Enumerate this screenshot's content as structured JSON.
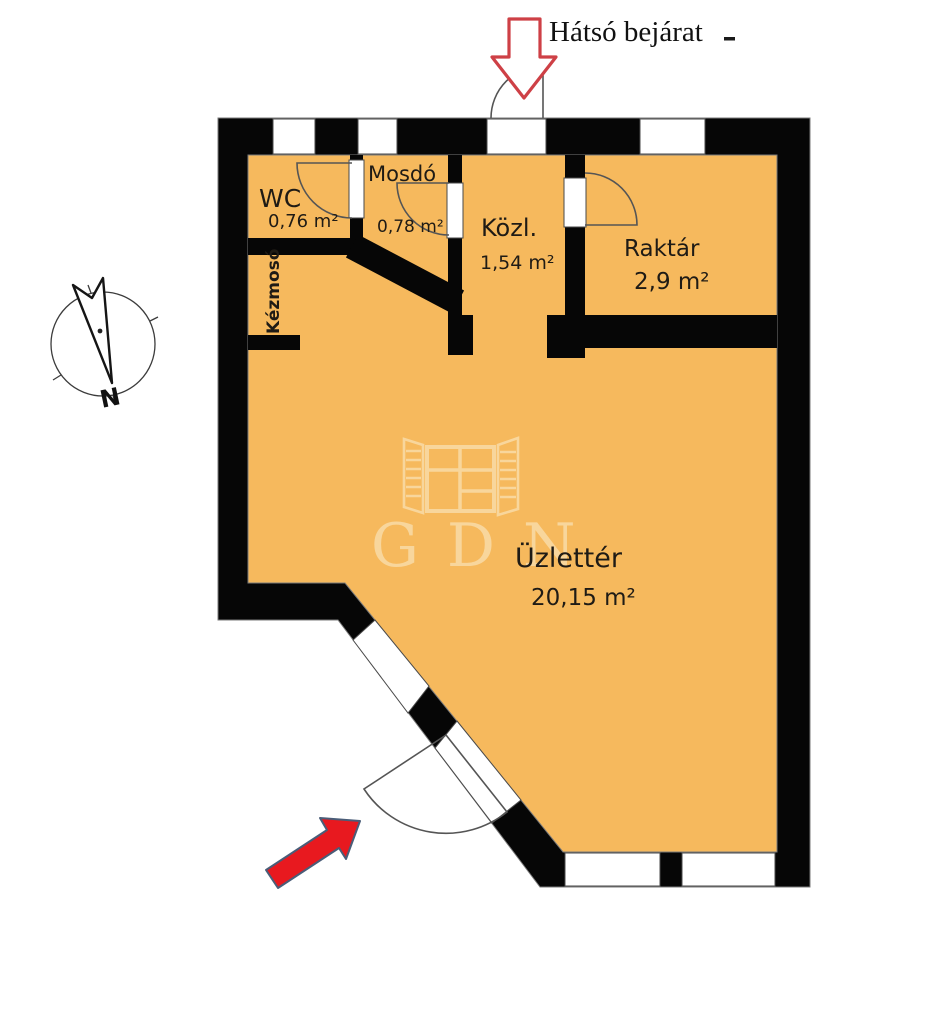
{
  "annotations": {
    "back_entrance": "Hátsó bejárat",
    "north": "N",
    "watermark_text": "GDN"
  },
  "rooms": {
    "wc": {
      "name": "WC",
      "area": "0,76 m²"
    },
    "mosdo": {
      "name": "Mosdó",
      "area": "0,78 m²"
    },
    "kozl": {
      "name": "Közl.",
      "area": "1,54 m²"
    },
    "raktar": {
      "name": "Raktár",
      "area": "2,9 m²"
    },
    "uzletter": {
      "name": "Üzlettér",
      "area": "20,15 m²"
    },
    "kezmoso": {
      "name": "Kézmosó"
    }
  },
  "colors": {
    "floor": "#F6B95D",
    "wall": "#060606",
    "label": "#1F1B15",
    "entry_arrow": "#E8191F",
    "back_arrow_outline": "#CE4046",
    "watermark": "#F9D8A0",
    "door_line": "#555555"
  }
}
